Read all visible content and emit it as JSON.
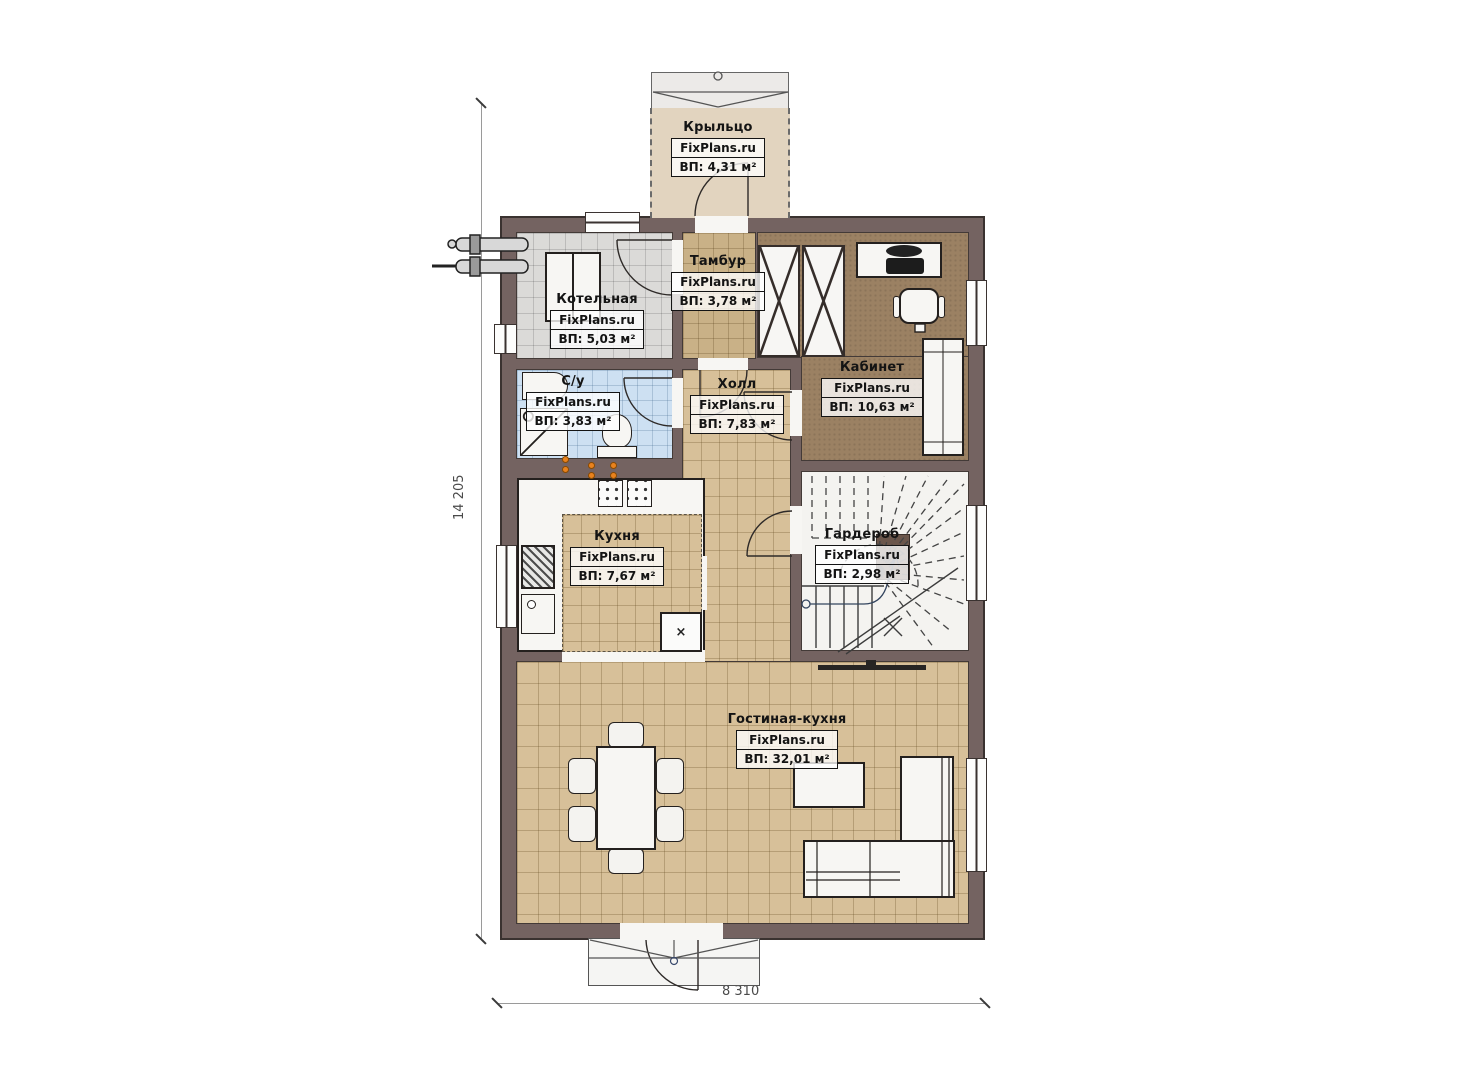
{
  "dimensions": {
    "left": "14 205",
    "bottom": "8 310"
  },
  "symbols": {
    "cross": "×"
  },
  "colors": {
    "wall": "#746361",
    "floor_beige": "#d7c099",
    "floor_gray": "#dbdad8",
    "floor_blue": "#cde0f2",
    "floor_office": "#9b8163",
    "porch": "#e2d4bf",
    "valve_orange": "#e8821e"
  },
  "rooms": [
    {
      "id": "porch",
      "name": "Крыльцо",
      "watermark": "FixPlans.ru",
      "area": "ВП: 4,31 м²"
    },
    {
      "id": "boiler",
      "name": "Котельная",
      "watermark": "FixPlans.ru",
      "area": "ВП: 5,03 м²"
    },
    {
      "id": "tambur",
      "name": "Тамбур",
      "watermark": "FixPlans.ru",
      "area": "ВП: 3,78 м²"
    },
    {
      "id": "office",
      "name": "Кабинет",
      "watermark": "FixPlans.ru",
      "area": "ВП: 10,63 м²"
    },
    {
      "id": "bath",
      "name": "С/у",
      "watermark": "FixPlans.ru",
      "area": "ВП: 3,83 м²"
    },
    {
      "id": "hall",
      "name": "Холл",
      "watermark": "FixPlans.ru",
      "area": "ВП: 7,83 м²"
    },
    {
      "id": "kitchen",
      "name": "Кухня",
      "watermark": "FixPlans.ru",
      "area": "ВП: 7,67 м²"
    },
    {
      "id": "wardrobe",
      "name": "Гардероб",
      "watermark": "FixPlans.ru",
      "area": "ВП: 2,98 м²"
    },
    {
      "id": "living",
      "name": "Гостиная-кухня",
      "watermark": "FixPlans.ru",
      "area": "ВП: 32,01 м²"
    }
  ]
}
